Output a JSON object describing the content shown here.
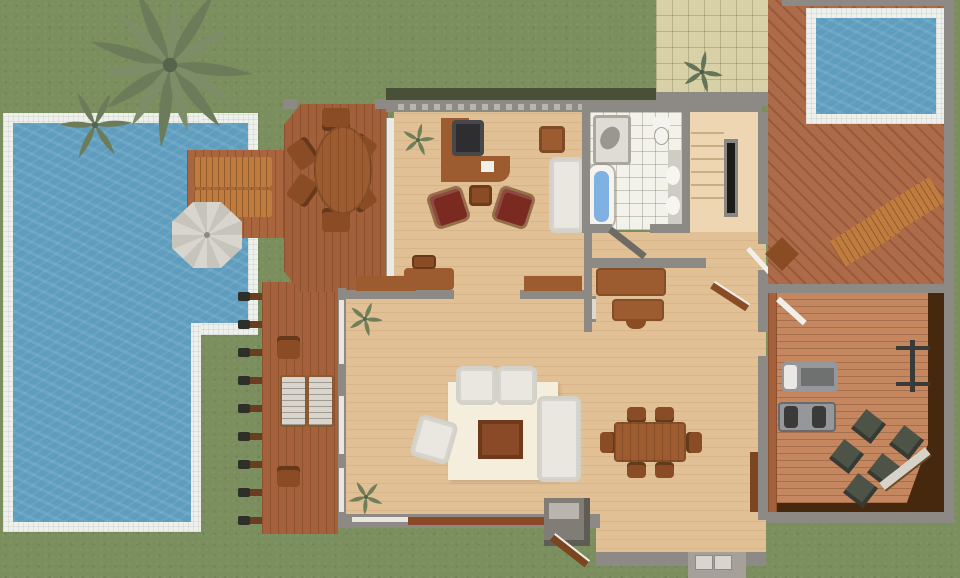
{
  "scene": {
    "kind": "architectural-floor-plan-top-view",
    "width_px": 960,
    "height_px": 578
  },
  "palette": {
    "grass": "#7b8e5d",
    "pool_water": "#5f9dbf",
    "pool_border": "#eef0ec",
    "tub_water": "#7fb2e2",
    "deck_wood": "#a8653e",
    "deck_octagon": "#a2603a",
    "pergola_deck": "#a4613c",
    "pergola_beam": "#6b3d1f",
    "wing_deck": "#ad6b49",
    "gym_floor": "#c4875f",
    "gym_dark_border": "#46280f",
    "house_floor": "#e2c096",
    "stairs_floor": "#eed6b2",
    "wall_gray": "#8d8a85",
    "wall_dark": "#6e6b66",
    "roof_shadow": "#3f4531",
    "bath_tile": "#f2f1ea",
    "patio_tile": "#d8d0a6",
    "rug_cream": "#f5eedd",
    "sofa_white": "#e9e7e0",
    "armchair_red": "#7b2a22",
    "wood_furniture": "#9c5c30",
    "wood_chair": "#8a4c24",
    "wood_dark": "#7a4520",
    "sunbed_wood": "#bf7c3e",
    "cushion_white": "#d7d5cd",
    "pouf_dark": "#4e5348",
    "equipment_gray": "#96979a",
    "equipment_dark": "#3a3a38",
    "appliance_white": "#dcd9d2",
    "plant_green": "#6f7f5a",
    "step_gray": "#a5a19a",
    "sill_brown": "#8a4a28"
  },
  "outdoor": {
    "lawn": "surrounds property",
    "main_pool": {
      "shape": "L-shaped",
      "position": "west",
      "border": "white tile"
    },
    "plunge_pool": {
      "shape": "rectangular",
      "position": "north-east",
      "border": "white tile"
    },
    "palm_trees": 2,
    "sun_deck": {
      "loungers": 2,
      "parasol": 1
    },
    "deck_dining": {
      "table": "oval",
      "chairs": 6
    },
    "pergola": {
      "beams": 9,
      "white_loungers": 2,
      "chairs": 2
    },
    "patio": {
      "finish": "beige tile",
      "plants": 1
    },
    "wing_loungers": 2,
    "entry_steps": 2
  },
  "rooms": {
    "study": {
      "furniture": [
        "corner-desk",
        "office-chair",
        "red-armchair",
        "red-armchair",
        "side-table",
        "white-sofa",
        "cabinet",
        "console-desk",
        "plant"
      ]
    },
    "bathroom": {
      "fixtures": [
        "shower",
        "bathtub",
        "toilet",
        "sink",
        "sink"
      ]
    },
    "staircase": {
      "treads": 6,
      "railing": 1
    },
    "kitchen": {
      "counters": 2,
      "island": 1,
      "sideboards": 2,
      "appliance": 1
    },
    "living_room": {
      "rug": 1,
      "sofa": 1,
      "white_armchairs": 3,
      "coffee_table": 1,
      "plants": 2
    },
    "dining_room": {
      "table": 1,
      "chairs": 6,
      "closet_door": 1
    },
    "gym": {
      "equipment": [
        "treadmill",
        "weight-station",
        "barbell-rack"
      ],
      "poufs": 5,
      "bench": 1
    }
  }
}
